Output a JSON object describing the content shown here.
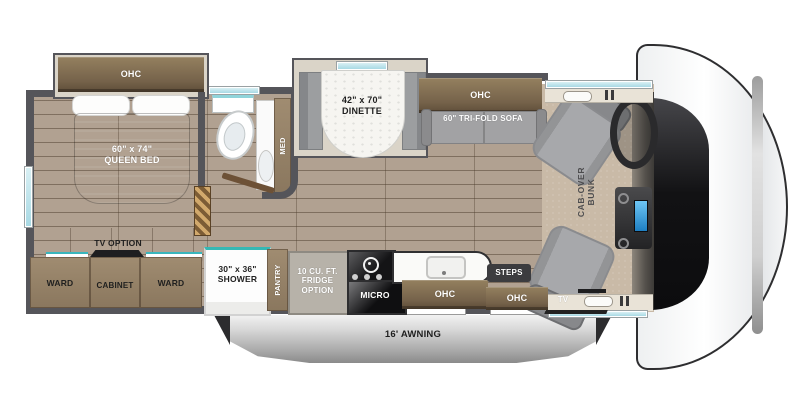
{
  "colors": {
    "wall": "#55555a",
    "wood_cabinet": "#75624a",
    "floor_plank": "#b1a191",
    "carpet": "#c9baa7",
    "accent_teal": "#39b6bd",
    "window_blue": "#a8d9e4",
    "awning_silver": "#c7c7c7",
    "seat_gray": "#a7a8ab",
    "bed_gray": "#5f646b"
  },
  "bedroom": {
    "ohc_label": "OHC",
    "bed_label": "60\" x 74\"\nQUEEN BED",
    "tv_option_label": "TV OPTION",
    "ward_left_label": "WARD",
    "cabinet_label": "CABINET",
    "ward_right_label": "WARD"
  },
  "bathroom": {
    "med_label": "MED",
    "shower_label": "30\" x 36\"\nSHOWER"
  },
  "living": {
    "dinette_label": "42\" x 70\"\nDINETTE",
    "sofa_ohc_label": "OHC",
    "sofa_label": "60\" TRI-FOLD SOFA"
  },
  "kitchen": {
    "pantry_label": "PANTRY",
    "fridge_label": "10 CU. FT.\nFRIDGE\nOPTION",
    "micro_label": "MICRO",
    "ohc_label": "OHC"
  },
  "entry": {
    "steps_label": "STEPS",
    "ohc_label": "OHC"
  },
  "cab": {
    "bunk_label": "CAB-OVER\nBUNK",
    "tv_label": "TV"
  },
  "exterior": {
    "awning_label": "16' AWNING"
  }
}
